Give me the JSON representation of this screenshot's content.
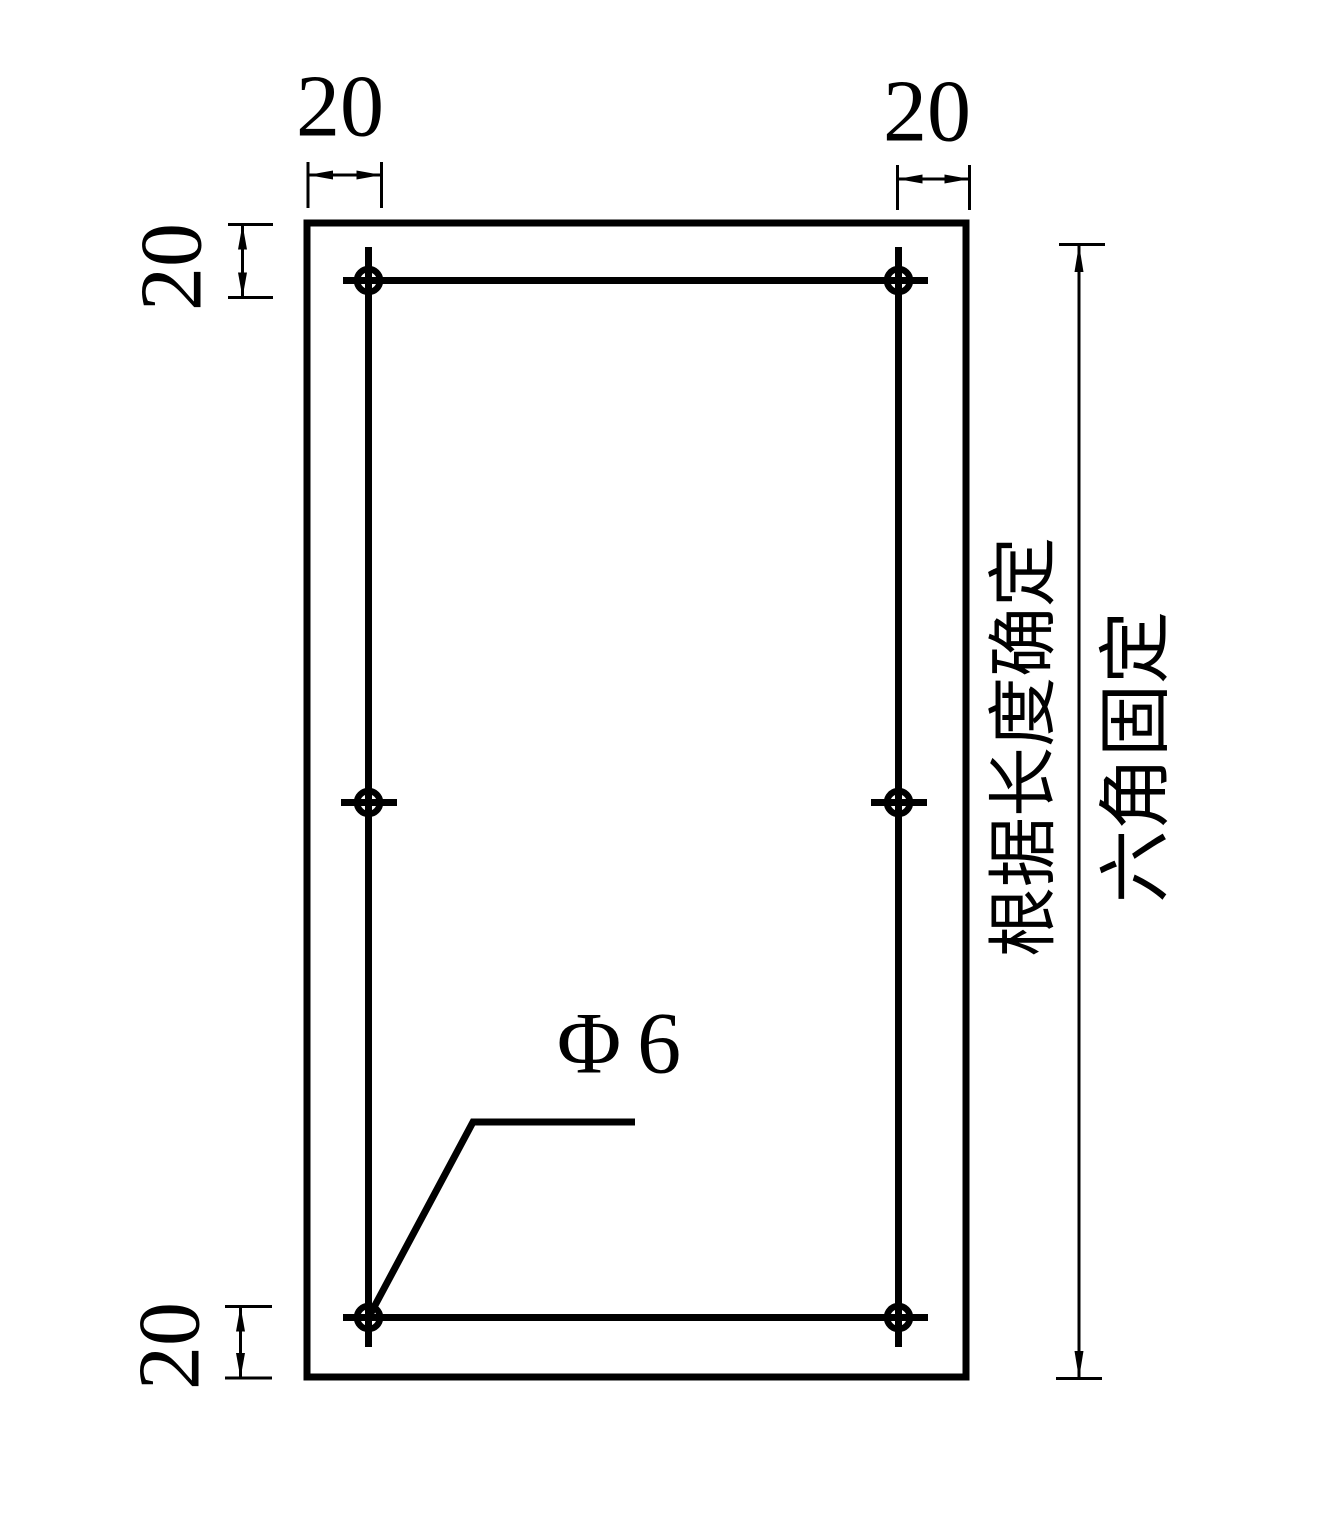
{
  "page": {
    "background": "#ffffff",
    "line_color": "#000000"
  },
  "drawing": {
    "type": "technical-drawing-hole-pattern",
    "dimension_labels": {
      "top_left": "20",
      "top_right": "20",
      "left_top": "20",
      "left_bottom": "20"
    },
    "hole_label": "Φ6",
    "notes": {
      "length": "根据长度确定",
      "fixing": "六角固定"
    }
  }
}
